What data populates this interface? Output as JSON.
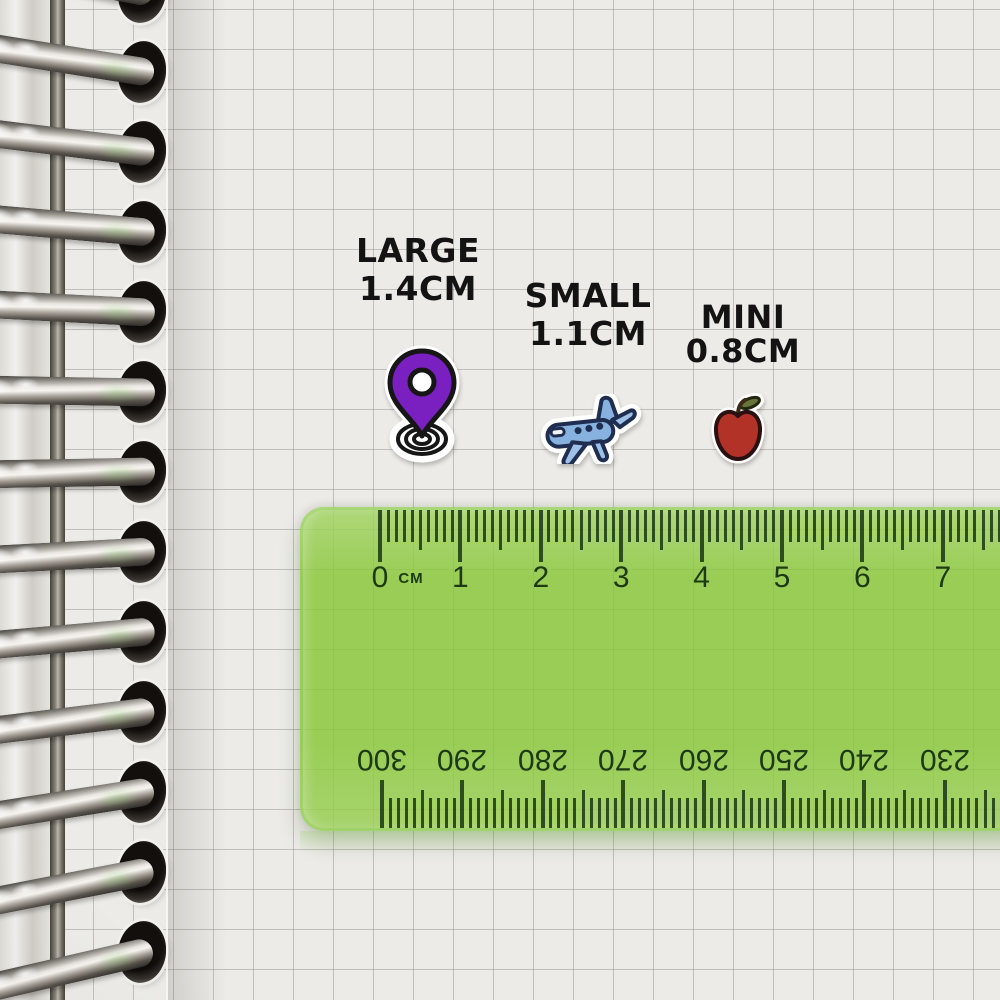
{
  "size_labels": [
    {
      "name": "LARGE",
      "size": "1.4CM"
    },
    {
      "name": "SMALL",
      "size": "1.1CM"
    },
    {
      "name": "MINI",
      "size": "0.8CM"
    }
  ],
  "stickers": [
    {
      "id": "location-pin",
      "primary_color": "#7a1fc0",
      "outline_color": "#161616"
    },
    {
      "id": "airplane",
      "primary_color": "#87b1de",
      "outline_color": "#1f2d50"
    },
    {
      "id": "apple",
      "primary_color": "#b23228",
      "outline_color": "#2a1010",
      "leaf_color": "#68753a",
      "stem_color": "#3a2a16"
    }
  ],
  "ruler": {
    "unit_label": "CM",
    "cm_labels": [
      "0",
      "1",
      "2",
      "3",
      "4",
      "5",
      "6",
      "7"
    ],
    "mm_labels": [
      "300",
      "290",
      "280",
      "270",
      "260",
      "250",
      "240",
      "230"
    ],
    "body_color": "#86c634",
    "mark_color": "#1d3a15"
  },
  "colors": {
    "paper": "#ecebe7",
    "label_text": "#131313",
    "sticker_base": "#ffffff"
  }
}
